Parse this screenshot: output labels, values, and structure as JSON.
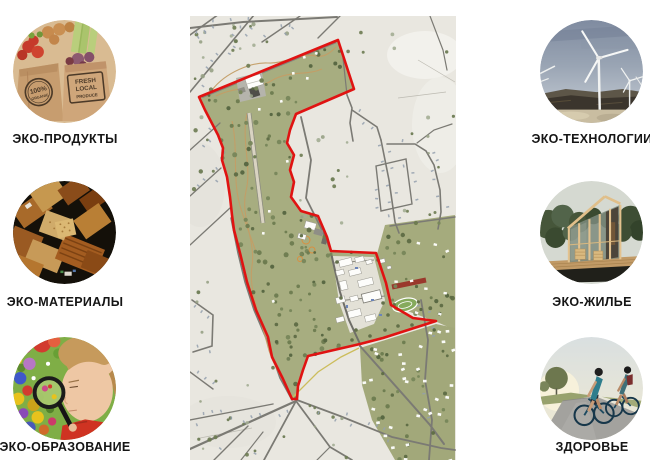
{
  "categories": {
    "left": [
      {
        "label": "ЭКО-ПРОДУКТЫ",
        "image": "organic-produce-bags",
        "badges": {
          "b1l1": "100%",
          "b1l2": "ORGANIC",
          "b2l1": "FRESH",
          "b2l2": "LOCAL",
          "b2l3": "PRODUCE"
        }
      },
      {
        "label": "ЭКО-МАТЕРИАЛЫ",
        "image": "wood-material-samples"
      },
      {
        "label": "ЭКО-ОБРАЗОВАНИЕ",
        "image": "child-with-magnifier"
      }
    ],
    "right": [
      {
        "label": "ЭКО-ТЕХНОЛОГИИ",
        "image": "wind-turbines"
      },
      {
        "label": "ЭКО-ЖИЛЬЕ",
        "image": "wooden-eco-house"
      },
      {
        "label": "ЗДОРОВЬЕ",
        "image": "cyclists-riding"
      }
    ]
  },
  "map": {
    "name": "site-master-plan",
    "boundary_color": "#e01312",
    "park_color": "#a7ad80"
  }
}
